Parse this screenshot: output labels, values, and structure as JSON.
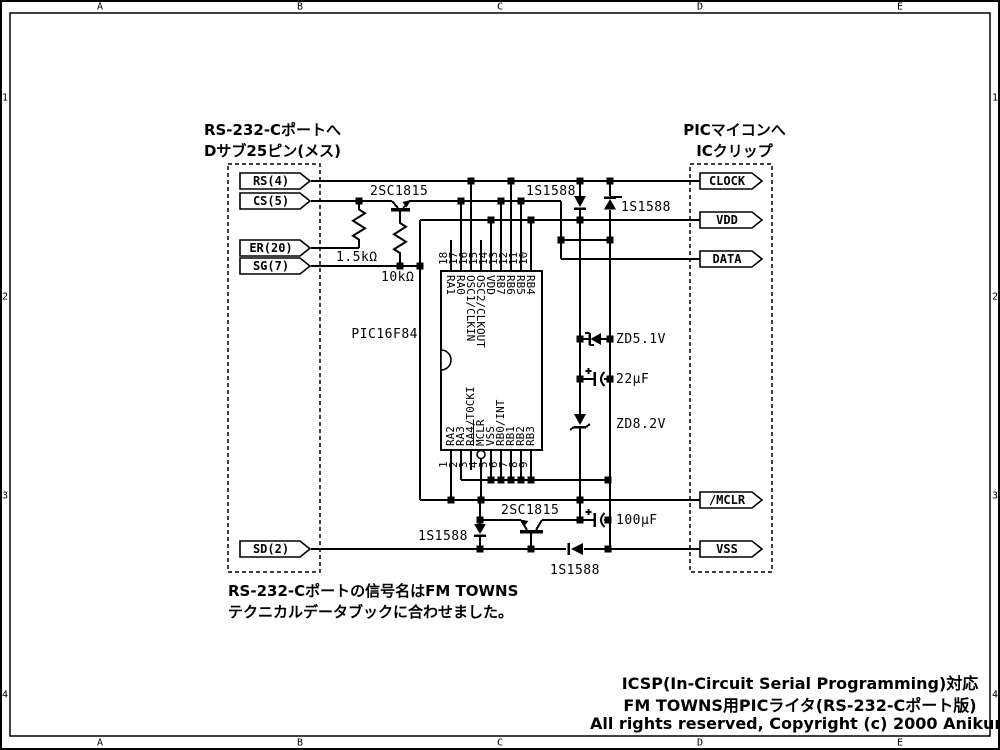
{
  "ruler": {
    "cols": [
      "A",
      "B",
      "C",
      "D",
      "E"
    ],
    "rows": [
      "1",
      "2",
      "3",
      "4"
    ]
  },
  "left_header": {
    "line1": "RS-232-Cポートへ",
    "line2": "Dサブ25ピン(メス)"
  },
  "right_header": {
    "line1": "PICマイコンへ",
    "line2": "ICクリップ"
  },
  "left_connectors": [
    "RS(4)",
    "CS(5)",
    "ER(20)",
    "SG(7)",
    "SD(2)"
  ],
  "right_connectors": [
    "CLOCK",
    "VDD",
    "DATA",
    "/MCLR",
    "VSS"
  ],
  "ic": {
    "name": "PIC16F84",
    "top_pins": [
      {
        "num": "18",
        "label": "RA1"
      },
      {
        "num": "17",
        "label": "RA0"
      },
      {
        "num": "16",
        "label": "OSC1/CLKIN"
      },
      {
        "num": "15",
        "label": "OSC2/CLKOUT"
      },
      {
        "num": "14",
        "label": "VDD"
      },
      {
        "num": "13",
        "label": "RB7"
      },
      {
        "num": "12",
        "label": "RB6"
      },
      {
        "num": "11",
        "label": "RB5"
      },
      {
        "num": "10",
        "label": "RB4"
      }
    ],
    "bottom_pins": [
      {
        "num": "1",
        "label": "RA2"
      },
      {
        "num": "2",
        "label": "RA3"
      },
      {
        "num": "3",
        "label": "RA4/T0CKI"
      },
      {
        "num": "4",
        "label": "MCLR",
        "overline": true
      },
      {
        "num": "5",
        "label": "VSS"
      },
      {
        "num": "6",
        "label": "RB0/INT"
      },
      {
        "num": "7",
        "label": "RB1"
      },
      {
        "num": "8",
        "label": "RB2"
      },
      {
        "num": "9",
        "label": "RB3"
      }
    ]
  },
  "parts": {
    "q1": "2SC1815",
    "q2": "2SC1815",
    "d1": "1S1588",
    "d2": "1S1588",
    "d3": "1S1588",
    "d4": "1S1588",
    "r1": "1.5kΩ",
    "r2": "10kΩ",
    "zd1": "ZD5.1V",
    "c1": "22µF",
    "zd2": "ZD8.2V",
    "c2": "100µF"
  },
  "note": {
    "line1": "RS-232-Cポートの信号名はFM TOWNS",
    "line2": "テクニカルデータブックに合わせました。"
  },
  "title": {
    "line1": "ICSP(In-Circuit Serial Programming)対応",
    "line2": "FM TOWNS用PICライタ(RS-232-Cポート版)",
    "line3": "All rights reserved, Copyright (c) 2000 Anikun."
  },
  "colors": {
    "ink": "#000000",
    "paper": "#ffffff"
  }
}
